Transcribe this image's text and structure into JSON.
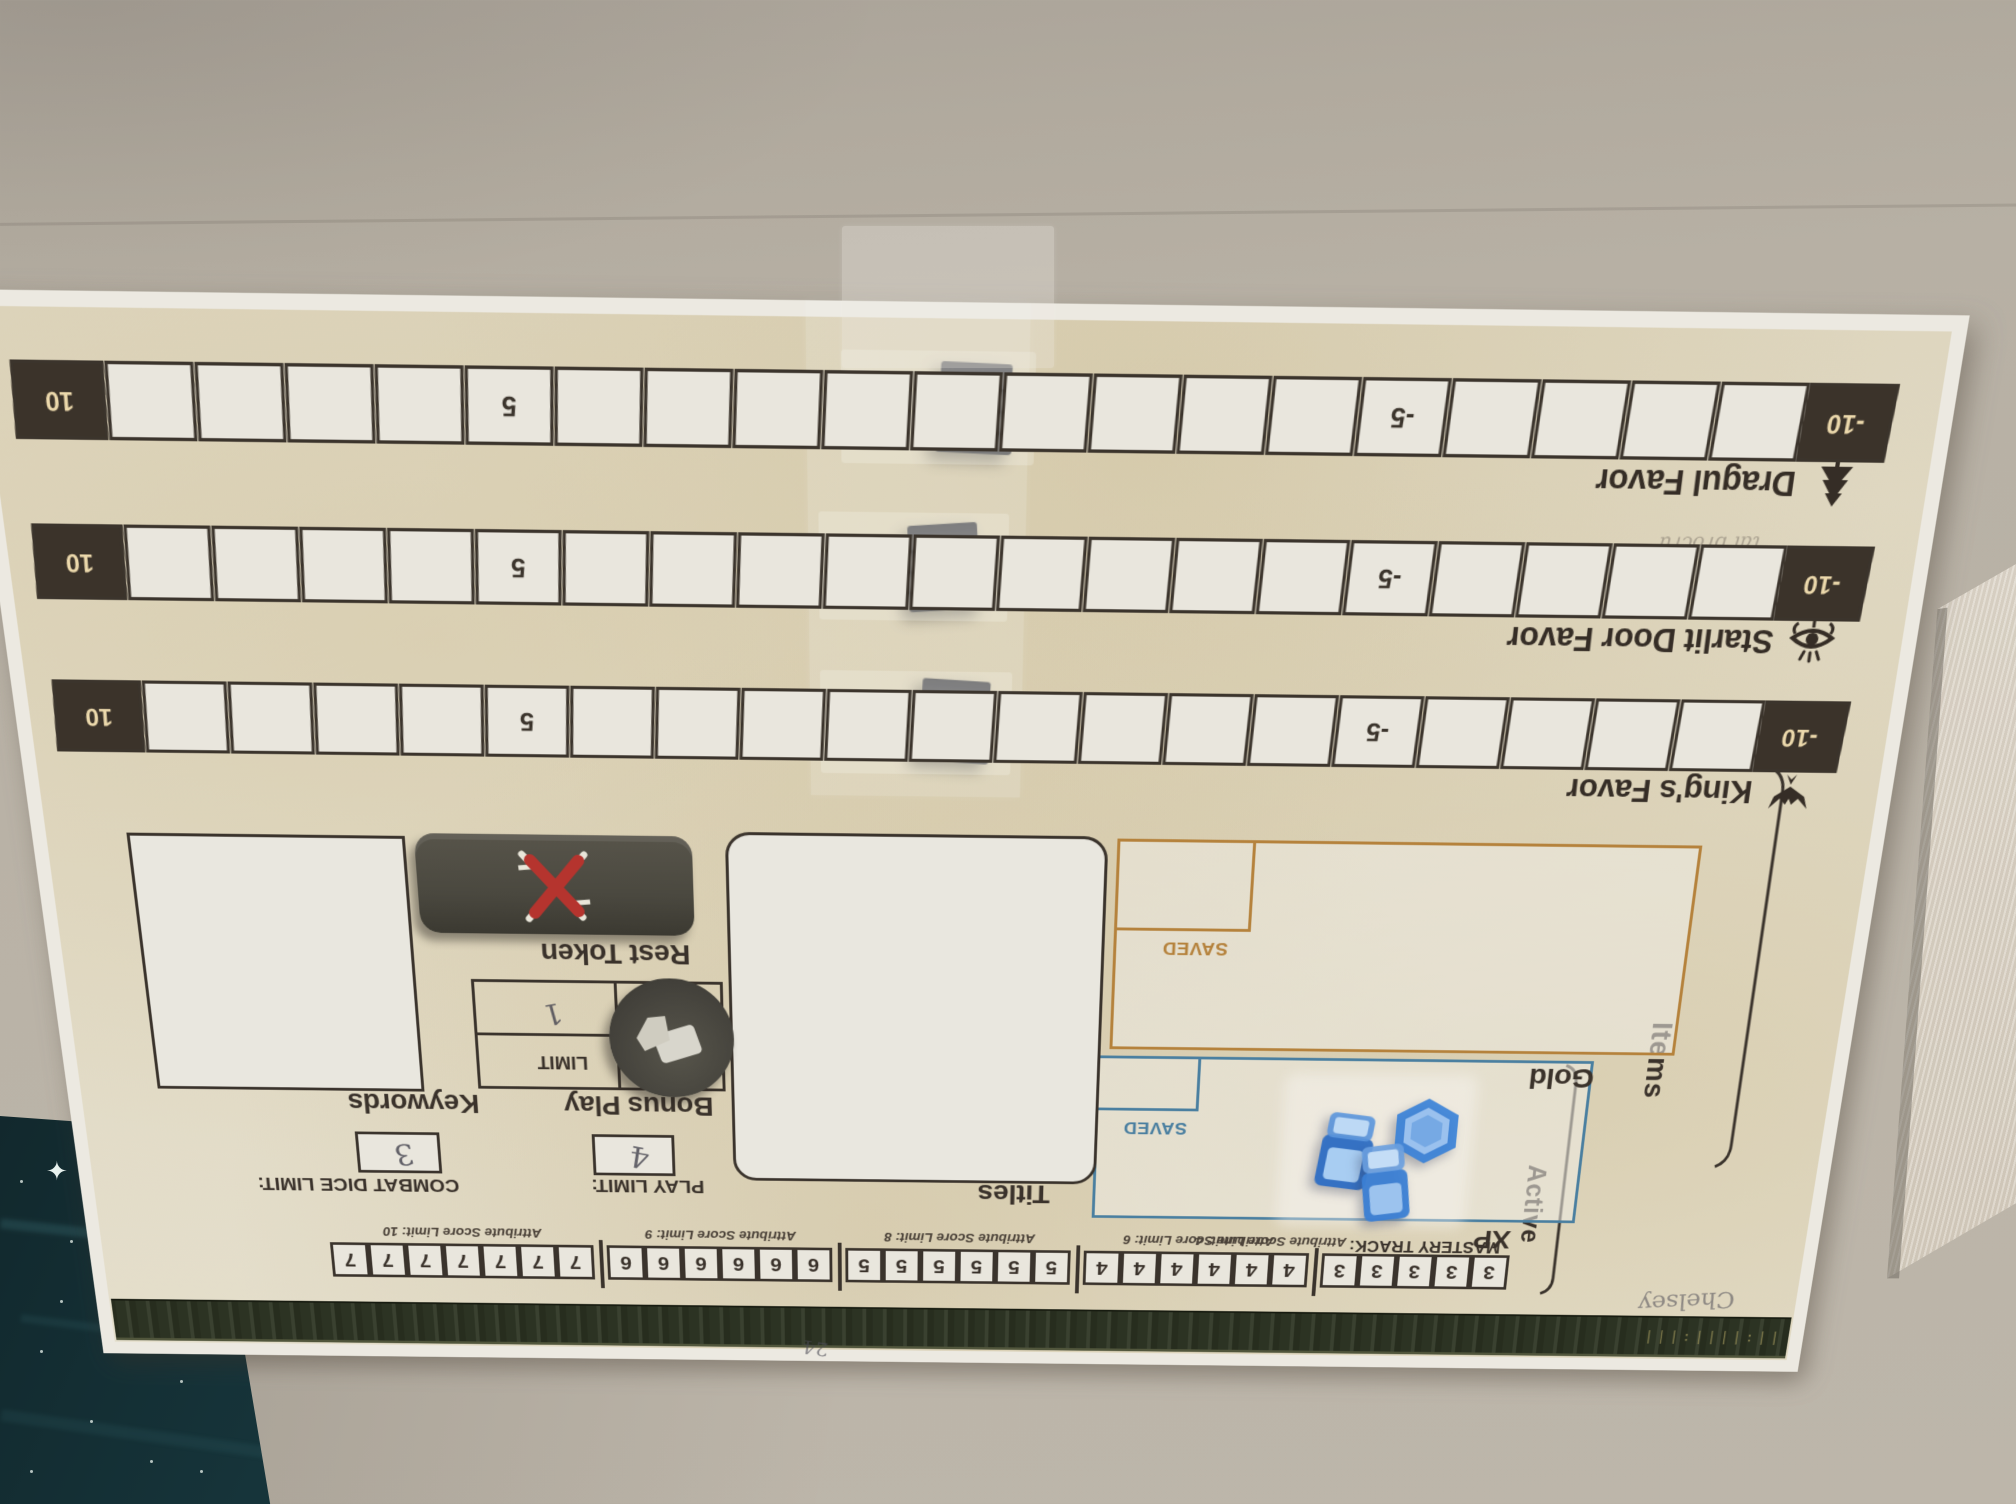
{
  "colors": {
    "ink": "#3a322b",
    "paper": "#e0d8c2",
    "gold_accent": "#b5823c",
    "xp_accent": "#4a7fa0",
    "rest_red": "#b5342e",
    "cube_black": "#1b1b1e",
    "token_olive": "#4a483f",
    "blue_token": "#3b82d8",
    "strip_green": "#2c3323"
  },
  "sheet": {
    "mastery": {
      "label": "MASTERY TRACK:",
      "active_label": "Active",
      "groups": [
        {
          "digit": "3",
          "count": 5
        },
        {
          "digit": "4",
          "count": 6
        },
        {
          "digit": "5",
          "count": 6
        },
        {
          "digit": "6",
          "count": 6
        },
        {
          "digit": "7",
          "count": 7
        }
      ],
      "limit_labels": [
        "Attribute Score Limit: 4",
        "Attribute Score Limit: 6",
        "Attribute Score Limit: 8",
        "Attribute Score Limit: 9",
        "Attribute Score Limit: 10"
      ]
    },
    "items_label": "Items",
    "xp": {
      "caption": "XP",
      "saved": "SAVED"
    },
    "gold": {
      "caption": "Gold",
      "saved": "SAVED"
    },
    "titles_caption": "Titles",
    "keywords_caption": "Keywords",
    "combat": {
      "label": "COMBAT DICE LIMIT:",
      "value": "3"
    },
    "play": {
      "label": "PLAY LIMIT:",
      "value": "4"
    },
    "bonus": {
      "caption": "Bonus Play",
      "limit_label": "LIMIT",
      "limit_value": "1"
    },
    "rest_caption": "Rest Token",
    "tracks": [
      {
        "name": "King's Favor",
        "icon": "dragon-icon",
        "cells": 21,
        "neg_end": "-10",
        "neg_mid": "-5",
        "pos_mid": "5",
        "pos_end": "10",
        "cube_index": 10
      },
      {
        "name": "Starlit Door Favor",
        "icon": "eye-icon",
        "cells": 21,
        "neg_end": "-10",
        "neg_mid": "-5",
        "pos_mid": "5",
        "pos_end": "10",
        "cube_index": 10
      },
      {
        "name": "Dragul Favor",
        "icon": "tree-icon",
        "cells": 21,
        "neg_end": "-10",
        "neg_mid": "-5",
        "pos_mid": "5",
        "pos_end": "10",
        "cube_index": 10
      }
    ],
    "handwriting": {
      "name": "Chelsey",
      "corner_mark": "24",
      "faint_note": "tal brocru"
    }
  }
}
